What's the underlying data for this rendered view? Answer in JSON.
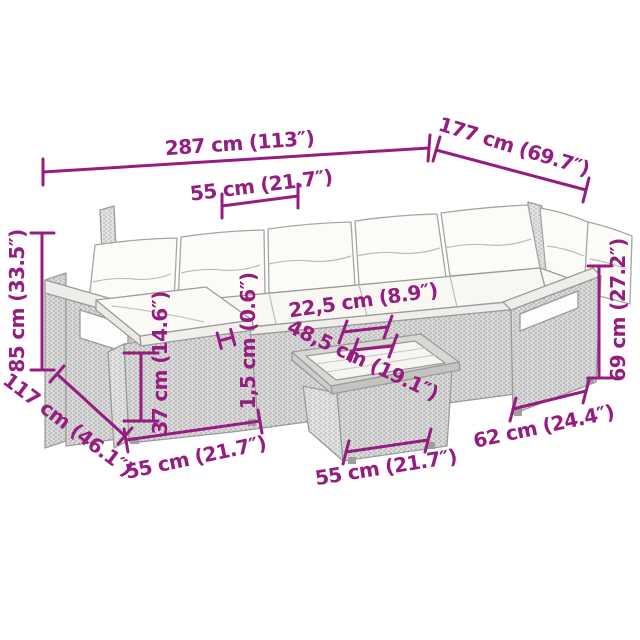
{
  "diagram": {
    "type": "product-dimension-diagram",
    "subject": "L-shaped garden sofa set with ottoman and coffee table",
    "accent_color": "#951d7f",
    "lineart_color": "#9b9b9b",
    "background": "#ffffff"
  },
  "dims": [
    {
      "name": "sofa-total-width",
      "label": "287 cm (113″)"
    },
    {
      "name": "seat-module-width",
      "label": "55 cm (21.7″)"
    },
    {
      "name": "sofa-total-depth",
      "label": "177 cm (69.7″)"
    },
    {
      "name": "backrest-height",
      "label": "85 cm (33.5″)"
    },
    {
      "name": "left-section-depth",
      "label": "117 cm (46.1″)"
    },
    {
      "name": "ottoman-width",
      "label": "55 cm (21.7″)"
    },
    {
      "name": "ottoman-height",
      "label": "37 cm (14.6″)"
    },
    {
      "name": "tabletop-thickness",
      "label": "1,5 cm (0.6″)"
    },
    {
      "name": "sofa-table-gap",
      "label": "22,5 cm (8.9″)"
    },
    {
      "name": "tabletop-width",
      "label": "48,5 cm (19.1″)"
    },
    {
      "name": "table-base-width",
      "label": "55 cm (21.7″)"
    },
    {
      "name": "right-seat-width",
      "label": "62 cm (24.4″)"
    },
    {
      "name": "armrest-height",
      "label": "69 cm (27.2″)"
    }
  ]
}
